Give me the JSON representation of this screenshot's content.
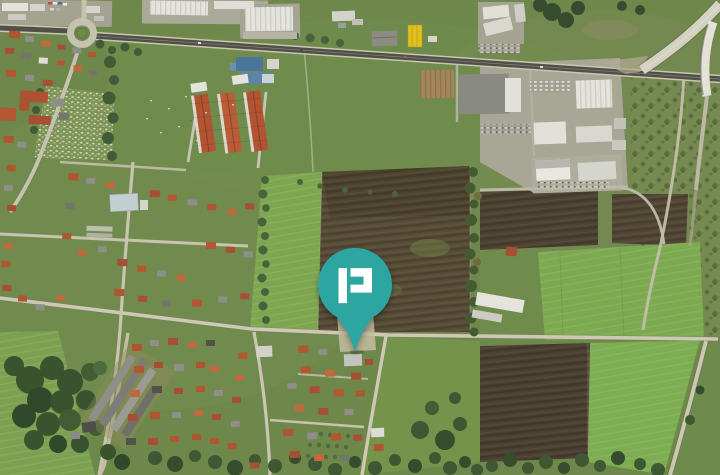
{
  "map": {
    "view": "satellite-aerial"
  },
  "marker": {
    "name": "location-pin",
    "glyph": "p-monogram",
    "pin_color": "#2da6a2",
    "glyph_color": "#ffffff",
    "left": "49.3%",
    "top": "74.2%"
  },
  "palette": {
    "grass": "#6d8749",
    "bright_field": "#7ea74e",
    "plowed_field": "#564a34",
    "plowed_dark": "#493d2f",
    "tree": "#3a5530",
    "road_light": "#cfc9b6",
    "road_asphalt": "#4f4c44",
    "ramp_concrete": "#d8d4c6",
    "building_white": "#e9e8e2",
    "building_tan": "#a5855a",
    "building_yellow": "#e6c11d",
    "roof_red": "#b0522f",
    "roof_terracotta": "#c0693a",
    "roof_blue": "#49739f",
    "parking": "#a3a194"
  }
}
